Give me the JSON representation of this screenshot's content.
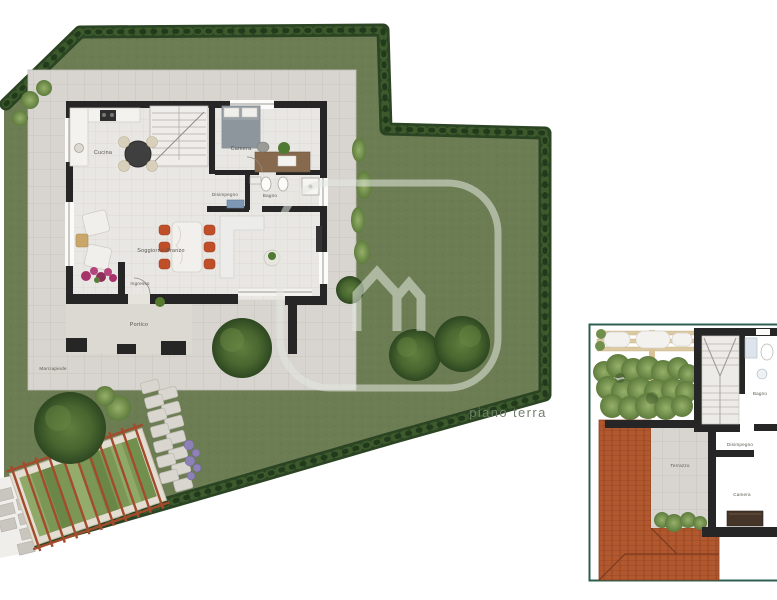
{
  "ground_floor": {
    "caption": "piano terra",
    "labels": {
      "cucina": "Cucina",
      "camera": "Camera",
      "disimpegno": "Disimpegno",
      "bagno": "Bagno",
      "soggiorno_pranzo": "Soggiorno-Pranzo",
      "ingresso": "Ingresso",
      "portico": "Portico",
      "marciapiede": "Marciapiede"
    }
  },
  "first_floor": {
    "labels": {
      "terrazzo": "Terrazzo",
      "disimpegno": "Disimpegno",
      "bagno": "Bagno",
      "camera": "Camera"
    }
  },
  "watermark": {
    "logo": "m-house-logo"
  },
  "colors": {
    "lawn": "#6d7d53",
    "hedge": "#2b4423",
    "pavement": "#d8d5d0",
    "walls": "#262626",
    "terracotta": "#b2582f",
    "panel_border": "#2d5f50",
    "caption": "#72806b",
    "chair_accent": "#bf4f28",
    "watermark": "#e4e8e0"
  }
}
